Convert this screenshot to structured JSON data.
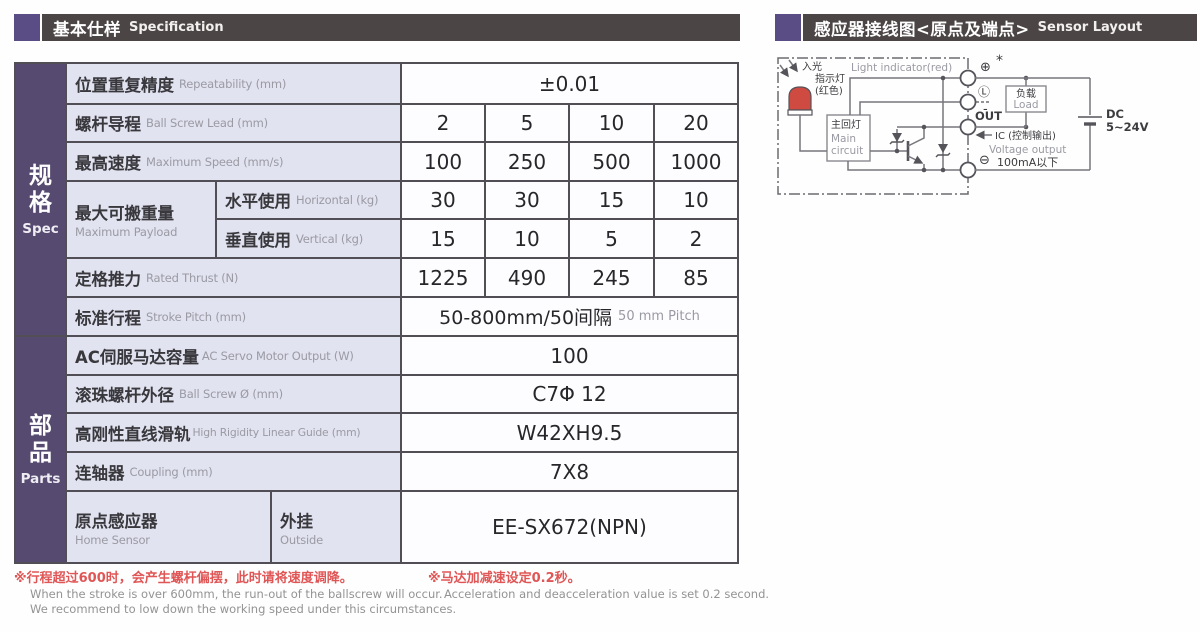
{
  "colors": {
    "header_bar": "#4b4545",
    "header_square": "#5a4d86",
    "sidebar_purple": "#564a70",
    "label_bg": "#e2e3f0",
    "table_border": "#514f55",
    "note_red": "#e05656",
    "note_gray": "#939393",
    "led_red": "#cf4a41"
  },
  "left_header": {
    "zh": "基本仕样",
    "en": "Specification"
  },
  "right_header": {
    "zh": "感应器接线图<原点及端点>",
    "en": "Sensor Layout"
  },
  "table": {
    "sidebar": {
      "spec_zh": "规格",
      "spec_en": "Spec",
      "parts_zh": "部品",
      "parts_en": "Parts"
    },
    "rows": {
      "repeatability": {
        "zh": "位置重复精度",
        "en": "Repeatability (mm)",
        "value": "±0.01"
      },
      "ball_screw_lead": {
        "zh": "螺杆导程",
        "en": "Ball Screw Lead (mm)",
        "values": [
          "2",
          "5",
          "10",
          "20"
        ]
      },
      "max_speed": {
        "zh": "最高速度",
        "en": "Maximum Speed (mm/s)",
        "values": [
          "100",
          "250",
          "500",
          "1000"
        ]
      },
      "max_payload": {
        "zh": "最大可搬重量",
        "en": "Maximum Payload",
        "horizontal": {
          "zh": "水平使用",
          "en": "Horizontal (kg)",
          "values": [
            "30",
            "30",
            "15",
            "10"
          ]
        },
        "vertical": {
          "zh": "垂直使用",
          "en": "Vertical (kg)",
          "values": [
            "15",
            "10",
            "5",
            "2"
          ]
        }
      },
      "rated_thrust": {
        "zh": "定格推力",
        "en": "Rated Thrust (N)",
        "values": [
          "1225",
          "490",
          "245",
          "85"
        ]
      },
      "stroke_pitch": {
        "zh": "标准行程",
        "en": "Stroke Pitch (mm)",
        "value_zh": "50-800mm/50间隔",
        "value_en": "50 mm Pitch"
      },
      "servo_output": {
        "zh": "AC伺服马达容量",
        "en": "AC Servo Motor Output (W)",
        "value": "100"
      },
      "ball_screw_dia": {
        "zh": "滚珠螺杆外径",
        "en": "Ball Screw Ø (mm)",
        "value": "C7Φ 12"
      },
      "linear_guide": {
        "zh": "高刚性直线滑轨",
        "en": "High Rigidity Linear Guide (mm)",
        "value": "W42XH9.5"
      },
      "coupling": {
        "zh": "连轴器",
        "en": "Coupling (mm)",
        "value": "7X8"
      },
      "home_sensor": {
        "zh": "原点感应器",
        "en": "Home Sensor",
        "sub_zh": "外挂",
        "sub_en": "Outside",
        "value": "EE-SX672(NPN)"
      }
    }
  },
  "notes": {
    "note1": {
      "zh": "※行程超过600时，会产生螺杆偏摆，此时请将速度调降。",
      "en1": "When the stroke is over 600mm, the run-out of the ballscrew will occur.",
      "en2": "We recommend to low down the working speed under this circumstances."
    },
    "note2": {
      "zh": "※马达加减速设定0.2秒。",
      "en1": "Acceleration and deacceleration value is set 0.2 second."
    }
  },
  "diagram": {
    "light_in_1": "入光",
    "light_in_2": "指示灯",
    "light_in_3": "(红色)",
    "light_indicator": "Light indicator(red)",
    "main_circuit_zh": "主回灯",
    "main_circuit_en1": "Main",
    "main_circuit_en2": "circuit",
    "load_zh": "负载",
    "load_en": "Load",
    "plus": "⊕",
    "star": "*",
    "l_terminal": "Ⓛ",
    "l_dash": "-",
    "out": "OUT",
    "minus": "⊖",
    "ic": "IC (控制输出)",
    "voltage_output": "Voltage output",
    "current_limit": "100mA以下",
    "dc": "DC",
    "dc_range": "5~24V"
  }
}
